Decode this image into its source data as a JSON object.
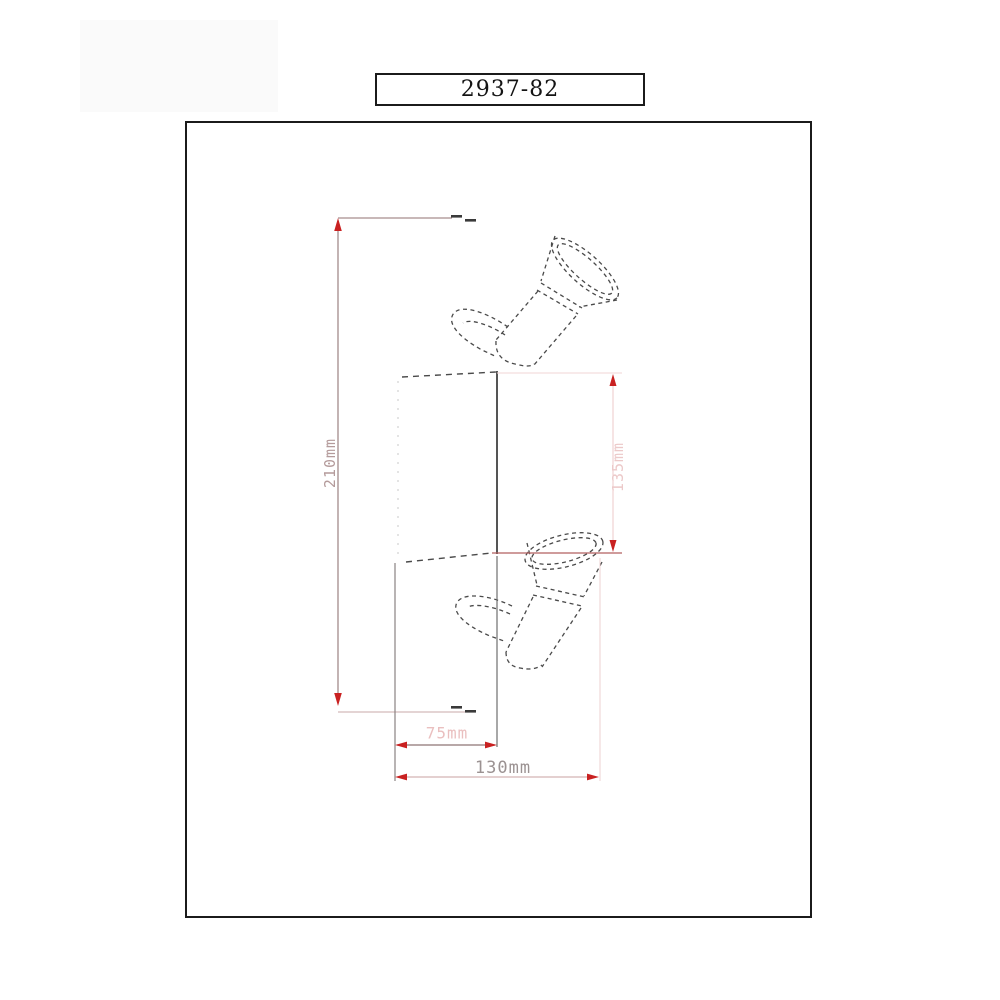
{
  "title_block": {
    "model": "2937-82"
  },
  "sheet": {
    "background": "#ffffff",
    "frame_color": "#1b1b1b"
  },
  "drawing": {
    "subject": "two-head adjustable spotlight fixture, side elevation, dashed outline",
    "line_color": "#4a4a4a",
    "accent_red": "#c92121",
    "dim_pink": "#eecaca",
    "dim_brown": "#9b8181"
  },
  "dimensions": {
    "overall_height": {
      "label": "210mm",
      "orientation": "vertical"
    },
    "body_height": {
      "label": "135mm",
      "orientation": "vertical"
    },
    "inner_width": {
      "label": "75mm",
      "orientation": "horizontal"
    },
    "overall_width": {
      "label": "130mm",
      "orientation": "horizontal"
    }
  }
}
